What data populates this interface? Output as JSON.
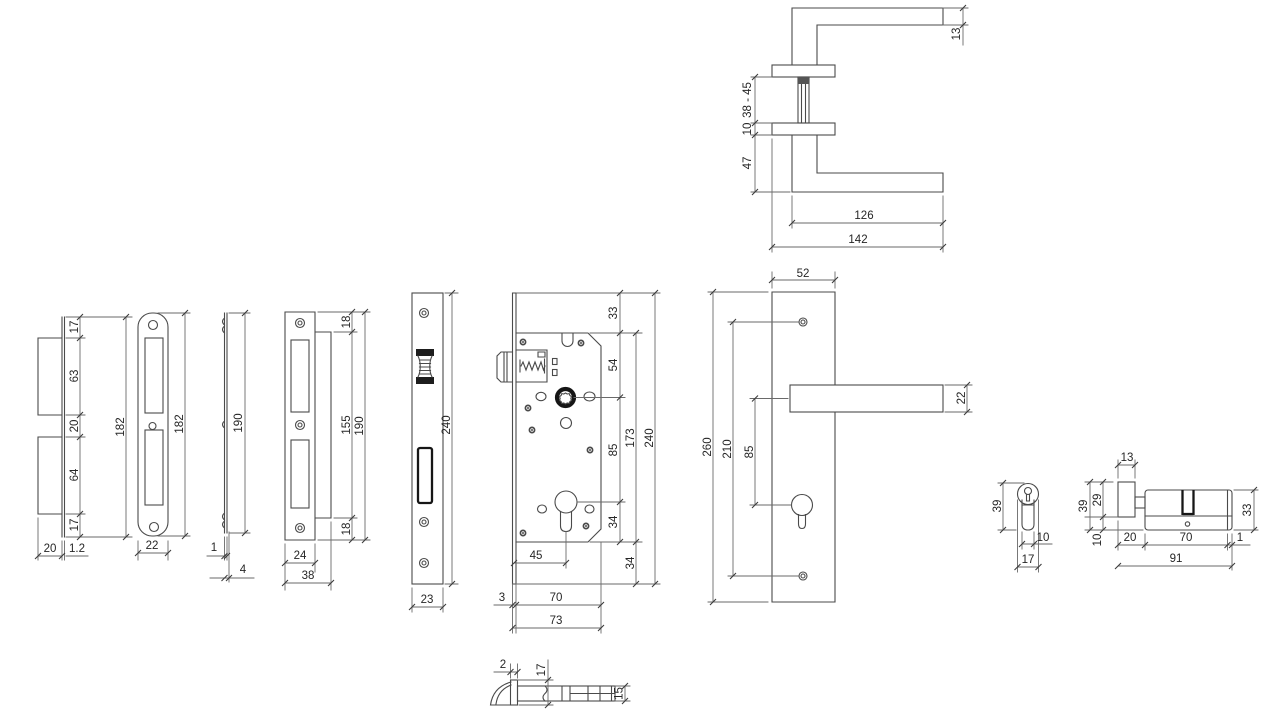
{
  "drawing": {
    "title": "lock-set-dimension-drawing",
    "views": {
      "strike_plate_side": {
        "dims": {
          "seg1": "17",
          "seg2": "63",
          "seg3": "20",
          "seg4": "64",
          "seg5": "17",
          "height": "182",
          "box_width": "20",
          "thickness": "1.2"
        }
      },
      "strike_plate_face": {
        "dims": {
          "height": "182",
          "width": "22"
        }
      },
      "strike_plate_edge": {
        "dims": {
          "height": "190",
          "thickness": "1",
          "depth": "4"
        }
      },
      "strike_plate_lip": {
        "dims": {
          "top": "18",
          "inner": "155",
          "height": "190",
          "bottom": "18",
          "face_width": "24",
          "width": "38"
        }
      },
      "forend": {
        "dims": {
          "height": "240",
          "width": "23"
        }
      },
      "lock_case": {
        "dims": {
          "top": "33",
          "follower": "54",
          "centres": "85",
          "case": "173",
          "height": "240",
          "cyl": "34",
          "bottom": "34",
          "backset": "45",
          "face": "3",
          "depth": "70",
          "total": "73"
        }
      },
      "handle": {
        "dims": {
          "bar": "13",
          "door_range": "38 - 45",
          "rose": "10",
          "drop": "47",
          "lever": "126",
          "length": "142"
        }
      },
      "backplate": {
        "dims": {
          "width": "52",
          "height": "260",
          "screws": "210",
          "centres": "85",
          "lever": "22"
        }
      },
      "cylinder_front": {
        "dims": {
          "height": "39",
          "body": "10",
          "width": "17"
        }
      },
      "cylinder_side": {
        "dims": {
          "knob_w": "13",
          "height": "39",
          "knob_h": "29",
          "offset": "10",
          "left": "20",
          "pin": "70",
          "edge": "1",
          "length": "91",
          "body_h": "33"
        }
      },
      "latch_detail": {
        "dims": {
          "plate": "2",
          "flange": "17",
          "bolt": "15"
        }
      }
    }
  }
}
